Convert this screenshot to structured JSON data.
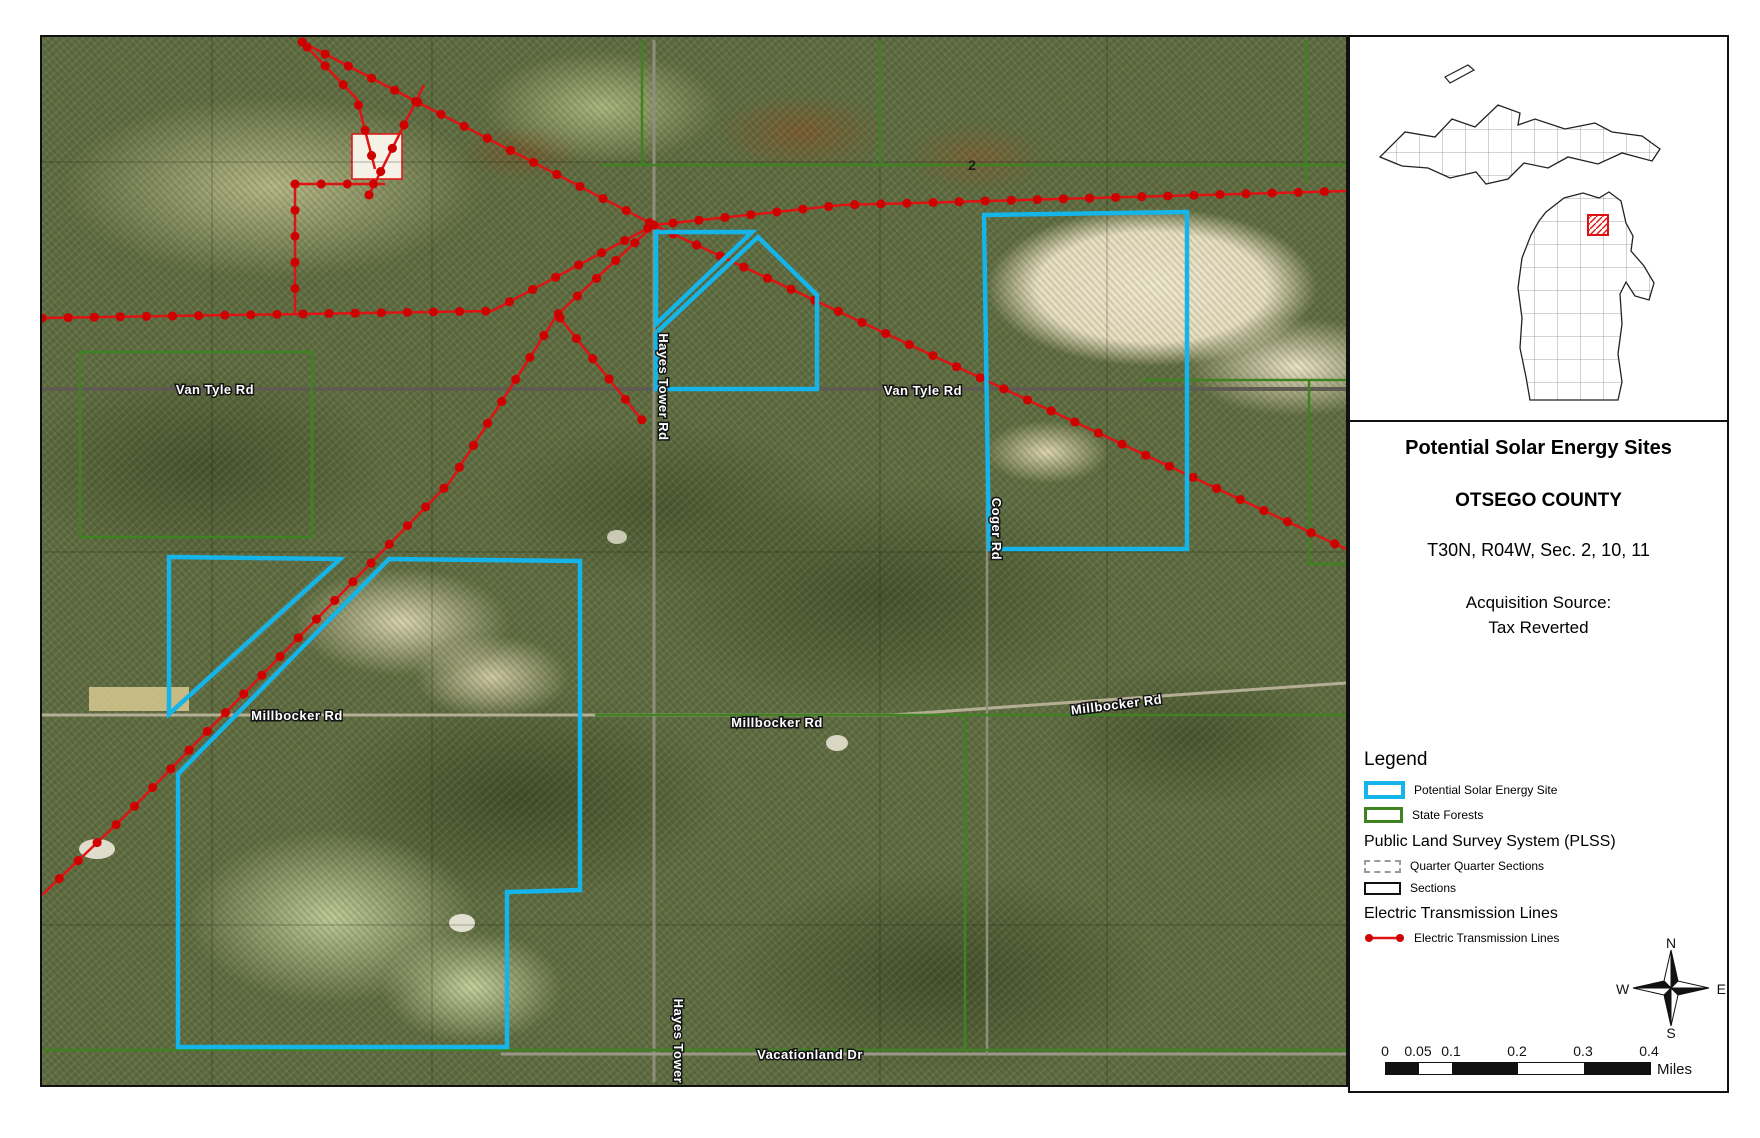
{
  "title_block": {
    "title": "Potential Solar Energy Sites",
    "county": "OTSEGO COUNTY",
    "township": "T30N, R04W, Sec. 2, 10, 11",
    "acquisition_label": "Acquisition Source:",
    "acquisition_value": "Tax Reverted"
  },
  "legend": {
    "header": "Legend",
    "solar_item": "Potential Solar Energy Site",
    "forest_item": "State Forests",
    "plss_header": "Public Land Survey System (PLSS)",
    "qq_item": "Quarter Quarter Sections",
    "sections_item": "Sections",
    "etl_header": "Electric Transmission Lines",
    "etl_item": "Electric Transmission Lines"
  },
  "compass": {
    "n": "N",
    "e": "E",
    "s": "S",
    "w": "W"
  },
  "scalebar": {
    "ticks": [
      "0",
      "0.05",
      "0.1",
      "0.2",
      "0.3",
      "0.4"
    ],
    "unit": "Miles"
  },
  "map": {
    "section_label": "2",
    "road_labels": [
      {
        "text": "Van Tyle Rd"
      },
      {
        "text": "Van Tyle Rd"
      },
      {
        "text": "Hayes Tower Rd"
      },
      {
        "text": "Coger Rd"
      },
      {
        "text": "Millbocker Rd"
      },
      {
        "text": "Millbocker Rd"
      },
      {
        "text": "Millbocker Rd"
      },
      {
        "text": "Vacationland Dr"
      },
      {
        "text": "Hayes Tower"
      }
    ],
    "colors": {
      "solar_site_outline": "#15b4e9",
      "state_forest_outline": "#3e8222",
      "transmission_line": "#e01313",
      "county_highlight": "#dd1111"
    }
  }
}
